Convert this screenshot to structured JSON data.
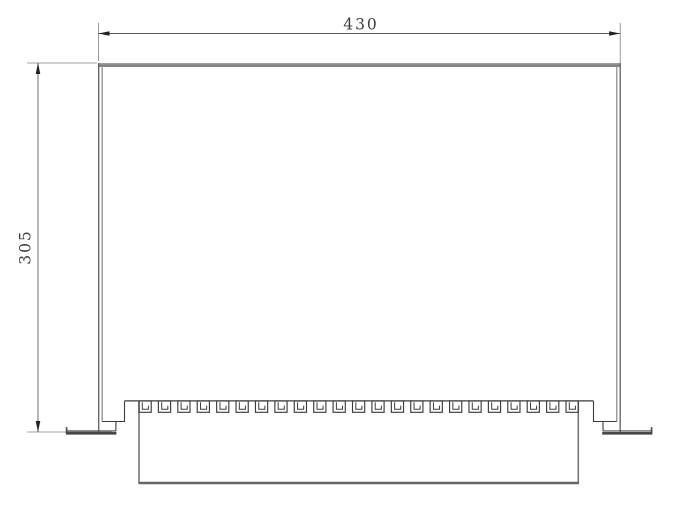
{
  "drawing": {
    "kind": "engineering-dimension-drawing",
    "view": "front elevation of rack enclosure with bottom terminal strip",
    "dimensions": {
      "width": {
        "value": 430,
        "label": "430",
        "units_per_px": 0.827
      },
      "height": {
        "value": 305,
        "label": "305",
        "units_per_px": 0.827
      }
    },
    "teeth": {
      "count": 23,
      "first_x": 139,
      "pitch": 19.41,
      "width": 12.2,
      "top_y": 401,
      "height": 11.3
    },
    "colors": {
      "background": "#ffffff",
      "line_gray": "#8f8f8f",
      "line_medium": "#757575",
      "line_dark": "#3c3c3c",
      "line_foot": "#474747",
      "dim_line": "#5a5a5a",
      "ext_line": "#808080",
      "arrow": "#222222",
      "text": "#3d3d3d"
    }
  }
}
